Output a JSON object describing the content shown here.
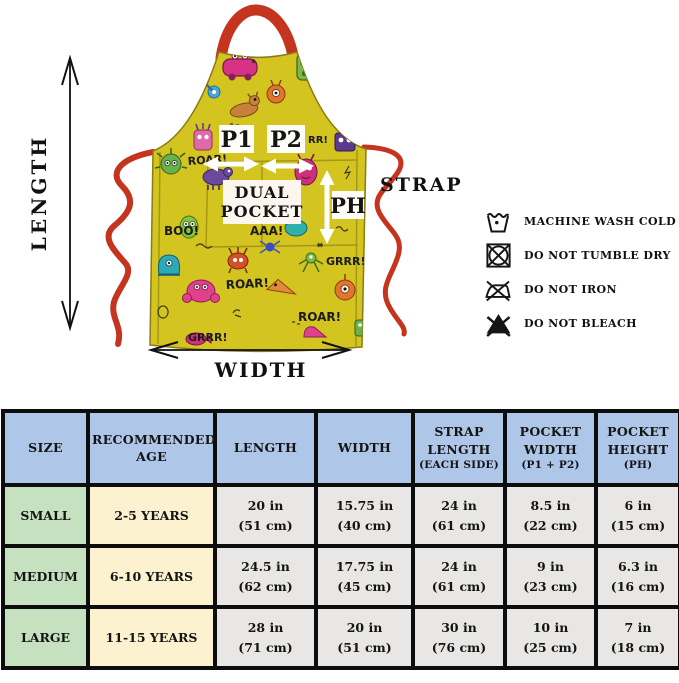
{
  "diagram": {
    "length_label": "LENGTH",
    "width_label": "WIDTH",
    "strap_label": "STRAP",
    "p1_label": "P1",
    "p2_label": "P2",
    "ph_label": "PH",
    "dual_pocket": {
      "line1": "DUAL",
      "line2": "POCKET"
    },
    "print_words": [
      "ROAR!",
      "RR!",
      "BOO!",
      "AAA!",
      "GRRR!",
      "ROAR!",
      "ROAR!",
      "GRRR!"
    ],
    "colors": {
      "fabric_yellow": "#d3c41f",
      "strap_red": "#c5341e"
    }
  },
  "care": {
    "items": [
      {
        "icon": "machine-wash-cold-icon",
        "label": "MACHINE WASH COLD"
      },
      {
        "icon": "do-not-tumble-dry-icon",
        "label": "DO NOT TUMBLE DRY"
      },
      {
        "icon": "do-not-iron-icon",
        "label": "DO NOT IRON"
      },
      {
        "icon": "do-not-bleach-icon",
        "label": "DO NOT BLEACH"
      }
    ]
  },
  "size_table": {
    "colors": {
      "header_blue": "#aec6e8",
      "size_green": "#c6e1c0",
      "age_cream": "#fdf2cf",
      "cell_gray": "#e8e7e5"
    },
    "headers": [
      {
        "label": "SIZE",
        "sub": ""
      },
      {
        "label": "RECOMMENDED AGE",
        "sub": ""
      },
      {
        "label": "LENGTH",
        "sub": ""
      },
      {
        "label": "WIDTH",
        "sub": ""
      },
      {
        "label": "STRAP LENGTH",
        "sub": "(EACH SIDE)"
      },
      {
        "label": "POCKET WIDTH",
        "sub": "(P1 + P2)"
      },
      {
        "label": "POCKET HEIGHT",
        "sub": "(PH)"
      }
    ],
    "rows": [
      {
        "size": "SMALL",
        "age": "2-5 YEARS",
        "length": [
          "20 in",
          "(51 cm)"
        ],
        "width": [
          "15.75 in",
          "(40 cm)"
        ],
        "strap": [
          "24 in",
          "(61 cm)"
        ],
        "pocket_width": [
          "8.5 in",
          "(22 cm)"
        ],
        "pocket_height": [
          "6 in",
          "(15 cm)"
        ]
      },
      {
        "size": "MEDIUM",
        "age": "6-10 YEARS",
        "length": [
          "24.5 in",
          "(62 cm)"
        ],
        "width": [
          "17.75 in",
          "(45 cm)"
        ],
        "strap": [
          "24 in",
          "(61 cm)"
        ],
        "pocket_width": [
          "9 in",
          "(23 cm)"
        ],
        "pocket_height": [
          "6.3 in",
          "(16 cm)"
        ]
      },
      {
        "size": "LARGE",
        "age": "11-15 YEARS",
        "length": [
          "28 in",
          "(71 cm)"
        ],
        "width": [
          "20 in",
          "(51 cm)"
        ],
        "strap": [
          "30 in",
          "(76 cm)"
        ],
        "pocket_width": [
          "10 in",
          "(25 cm)"
        ],
        "pocket_height": [
          "7 in",
          "(18 cm)"
        ]
      }
    ]
  }
}
